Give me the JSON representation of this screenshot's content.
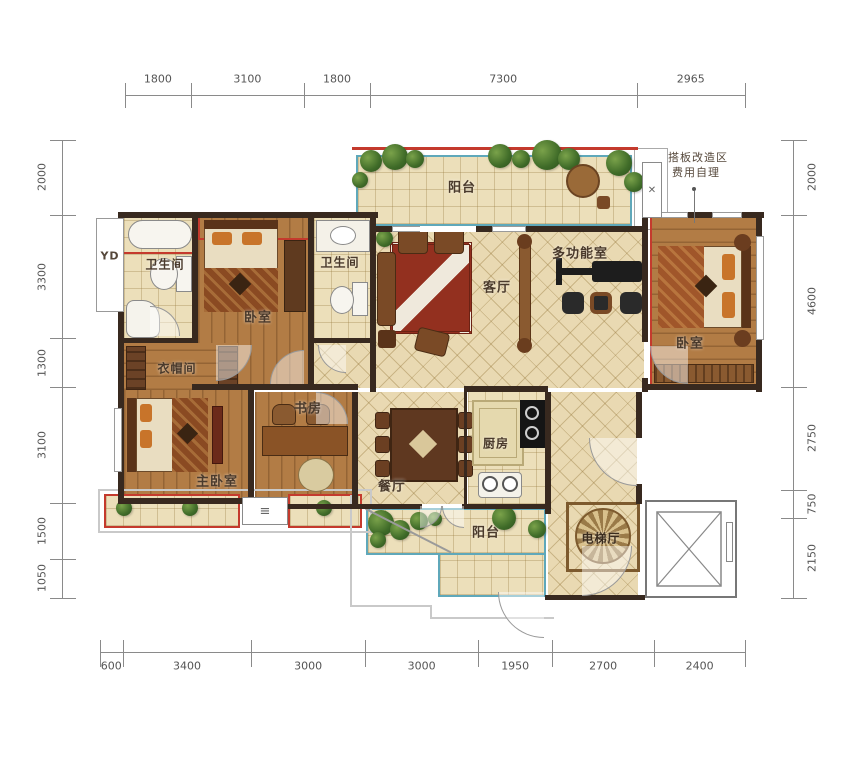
{
  "dimensions": {
    "top": [
      1800,
      3100,
      1800,
      7300,
      2965
    ],
    "left": [
      2000,
      3300,
      1300,
      3100,
      1500,
      1050
    ],
    "right": [
      2000,
      4600,
      2750,
      750,
      2150
    ],
    "bottom": [
      600,
      3400,
      3000,
      3000,
      1950,
      2700,
      2400
    ]
  },
  "rooms": {
    "balcony_top": "阳台",
    "bathroom_left": "卫生间",
    "bedroom_top": "卧室",
    "bathroom_mid": "卫生间",
    "living": "客厅",
    "multi": "多功能室",
    "bedroom_right": "卧室",
    "cloakroom": "衣帽间",
    "master": "主卧室",
    "study": "书房",
    "dining": "餐厅",
    "kitchen": "厨房",
    "balcony_bottom": "阳台",
    "elevator_hall": "电梯厅"
  },
  "annotations": {
    "note_line1": "搭板改造区",
    "note_line2": "费用自理",
    "duct_label": "YD"
  },
  "icons": {
    "ac_cross": "✕",
    "vent": "≡"
  },
  "colors": {
    "accent_red": "#c43a2d",
    "accent_teal": "#5fa8ba",
    "wall": "#38291f",
    "wood": "#b27c45",
    "tile": "#e9d9b2"
  }
}
